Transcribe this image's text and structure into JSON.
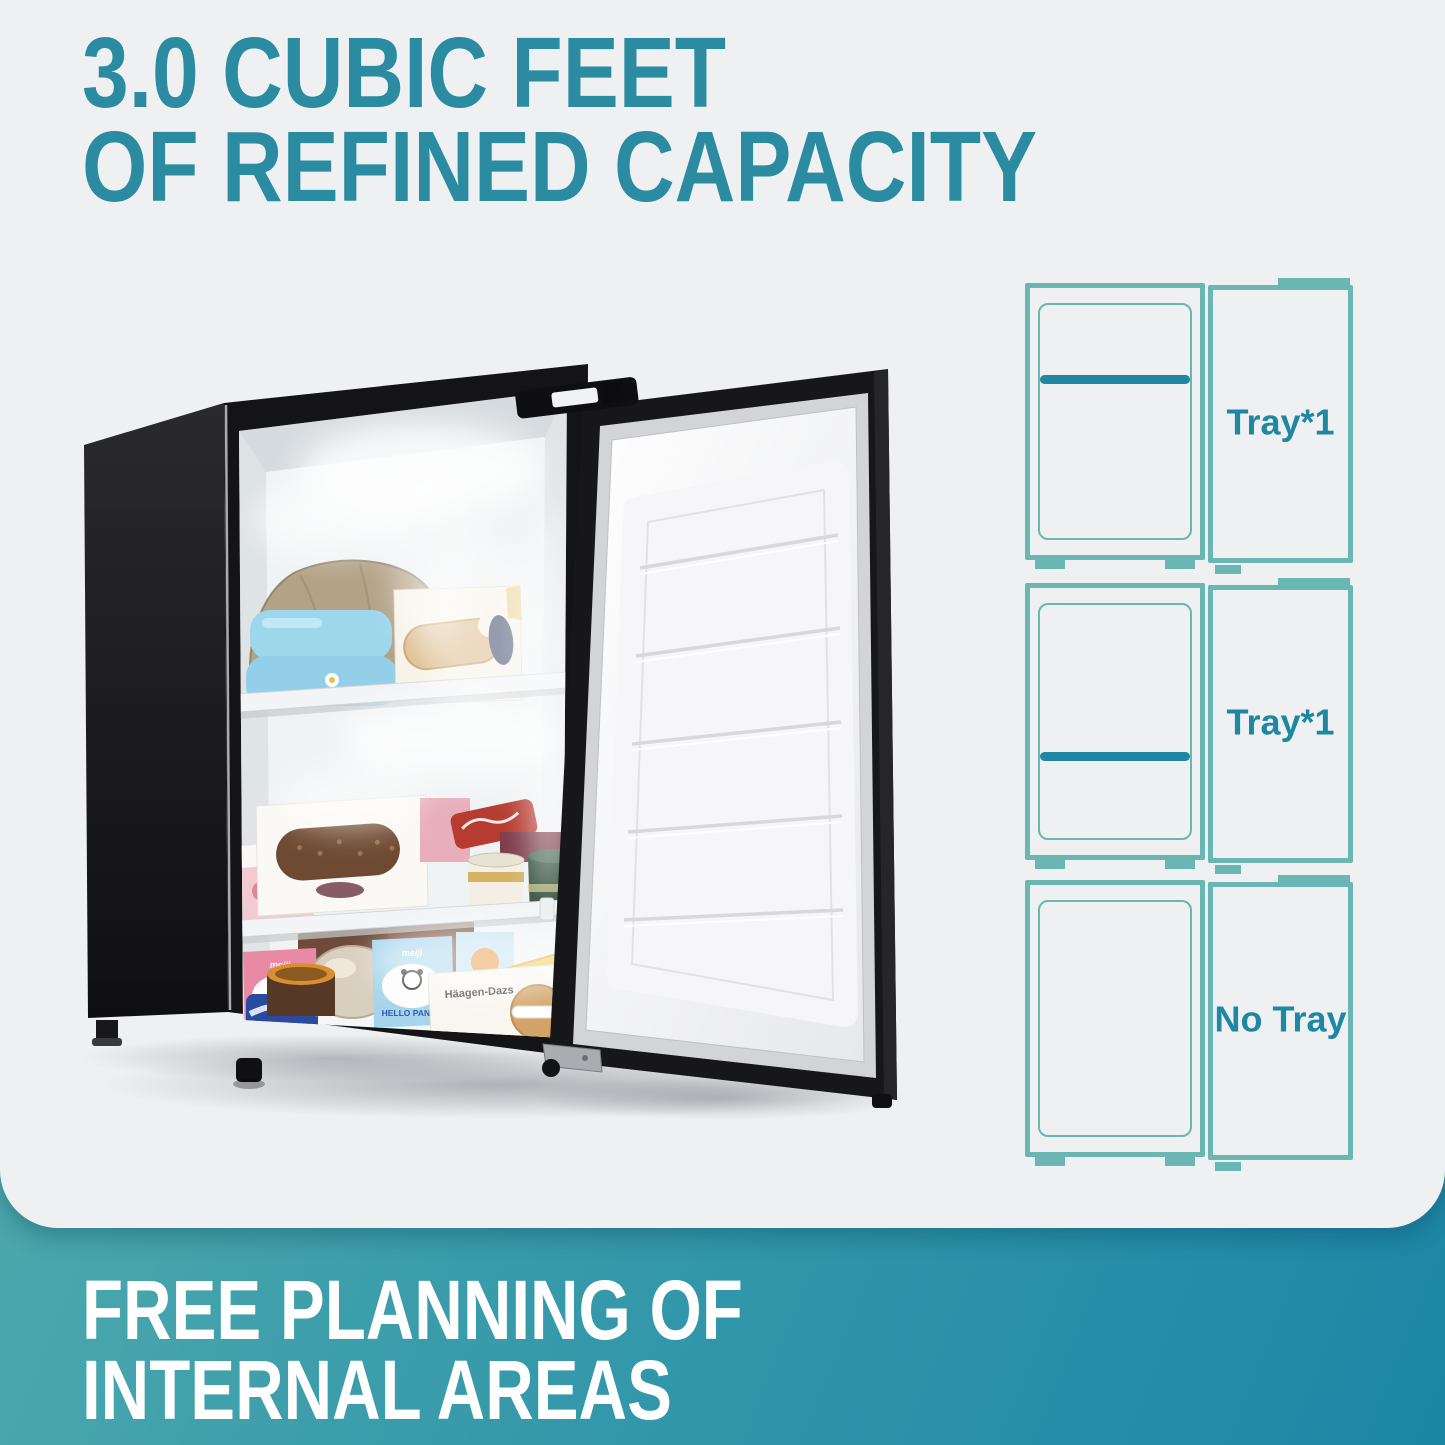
{
  "page": {
    "background_color": "#eef0f1"
  },
  "headline": {
    "line1": "3.0 CUBIC FEET",
    "line2": "OF REFINED CAPACITY",
    "color": "#2a8ba1"
  },
  "diagrams": {
    "outline_color": "#6ab6b3",
    "accent_color": "#1e87a2",
    "items": [
      {
        "label": "Tray*1",
        "has_tray": true,
        "tray_position_pct": 30
      },
      {
        "label": "Tray*1",
        "has_tray": true,
        "tray_position_pct": 63
      },
      {
        "label": "No Tray",
        "has_tray": false,
        "tray_position_pct": null
      }
    ]
  },
  "footer": {
    "line1": "FREE PLANNING OF",
    "line2": "INTERNAL AREAS",
    "text_color": "#ffffff",
    "gradient_start": "#5cb3ae",
    "gradient_end": "#1b86a6"
  },
  "photo": {
    "subject": "black-compact-upright-freezer-door-open-filled-with-frozen-food",
    "food_labels": {
      "hello_panda": "HELLO PANDA",
      "meiji": "meiji",
      "haagen_dazs": "Häagen-Dazs"
    }
  }
}
